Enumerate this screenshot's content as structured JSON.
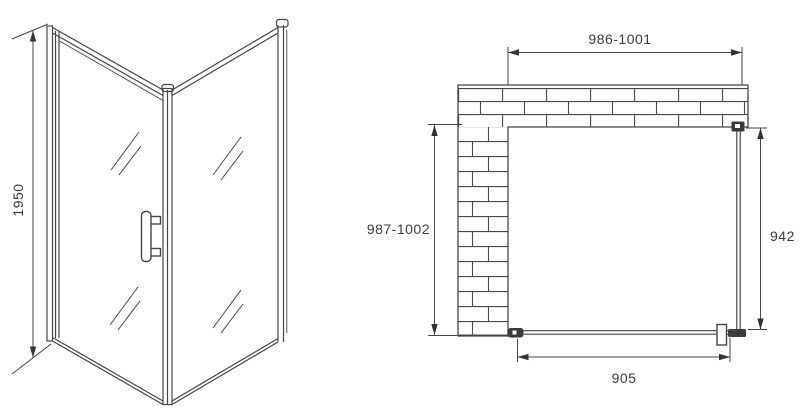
{
  "drawing": {
    "dimensions": {
      "height": "1950",
      "width_top": "986-1001",
      "depth_left": "987-1002",
      "side_panel": "942",
      "door": "905"
    },
    "colors": {
      "line": "#454545",
      "text": "#3c3c3c",
      "solid": "#333333",
      "background": "#ffffff"
    }
  }
}
